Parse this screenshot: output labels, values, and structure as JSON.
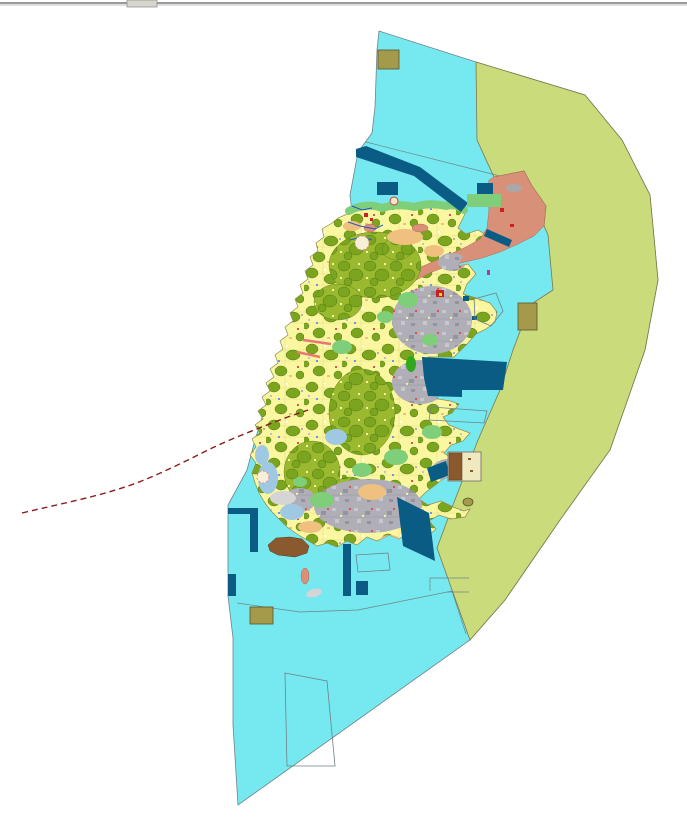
{
  "window": {
    "chrome": {
      "top_divider_present": true,
      "divider_color": "#9A9A9A",
      "divider_highlight": "#DEDEDE",
      "thumb_color": "#D7D4CB"
    }
  },
  "map": {
    "visible_text": [],
    "regions": [
      {
        "name": "open-water",
        "color": "#76E8F0"
      },
      {
        "name": "eastern-coastal-buffer-zone",
        "color": "#C9DB7B"
      },
      {
        "name": "island-agricultural-mosaic",
        "color": "#FAF7A0"
      },
      {
        "name": "forest-orchard-parcels",
        "color": "#7CA51F"
      },
      {
        "name": "built-up-urban-area",
        "color": "#B0AEB6"
      },
      {
        "name": "northeast-salmon-zone",
        "color": "#D99078"
      },
      {
        "name": "harbor-breakwater-structures",
        "color": "#0A5C84"
      },
      {
        "name": "coastal-green-belt",
        "color": "#7FCE7A"
      },
      {
        "name": "khaki-parcels",
        "color": "#A59A49"
      },
      {
        "name": "brown-reclamation-area",
        "color": "#8A5A2E"
      },
      {
        "name": "shallow-water-patches",
        "color": "#9FC8E2"
      },
      {
        "name": "dashed-route-line",
        "color": "#8B1A1A"
      },
      {
        "name": "pier-marks",
        "color": "#E87878"
      },
      {
        "name": "stream-lines",
        "color": "#2255CC"
      },
      {
        "name": "planning-outline-polygons",
        "color": "#6F8288"
      }
    ]
  },
  "colors": {
    "water": "#76E8F0",
    "buffer": "#C9DB7B",
    "land": "#FAF7A0",
    "forest": "#7CA51F",
    "forestdark": "#4C7A12",
    "forestbg": "#9BB92F",
    "urban": "#B0AEB6",
    "urbanlight": "#C9C7CE",
    "urbandark": "#95939D",
    "salmon": "#D99078",
    "navy": "#0A5C84",
    "green": "#7FCE7A",
    "brightgreen": "#2FA81E",
    "tan": "#EFC07E",
    "khaki": "#A59A49",
    "brown": "#8A5A2E",
    "lightblue": "#9FC8E2",
    "shoal": "#D5D5D5",
    "redline": "#8B1A1A",
    "pier": "#E87878",
    "stream": "#2255CC",
    "mapline": "#6F8288",
    "bufferline": "#7A7A4A",
    "islandline": "#8B8B50",
    "barline1": "#9A9A9A",
    "barline2": "#DEDEDE",
    "barthumb": "#D7D4CB"
  }
}
